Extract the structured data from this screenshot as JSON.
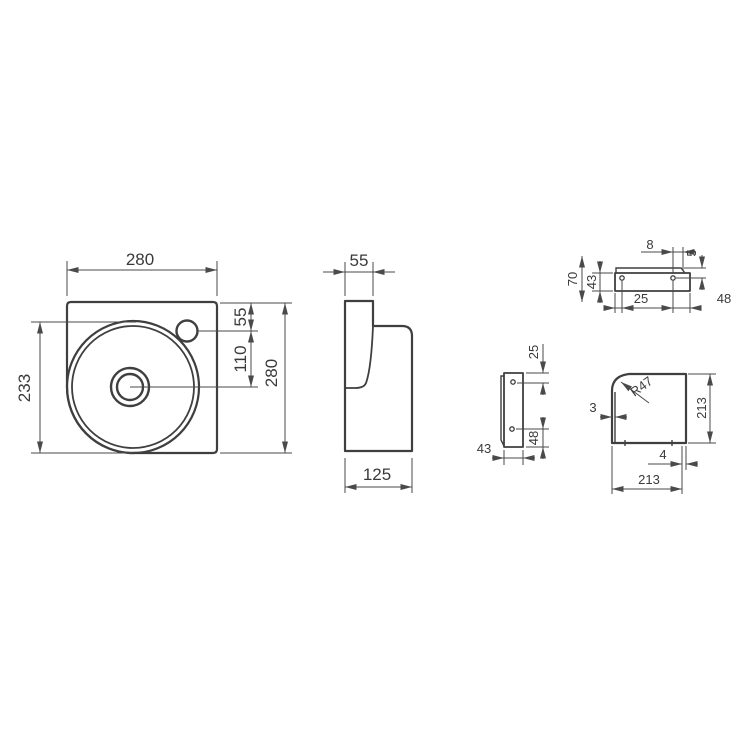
{
  "drawing_title": "washbasin-technical-drawing",
  "colors": {
    "background": "#ffffff",
    "outline": "#3f3f3f",
    "dimension_line": "#4a4a4a",
    "text": "#3a3a3a"
  },
  "front_view": {
    "width_mm": "280",
    "height_mm": "280",
    "bowl_to_bottom_mm": "233",
    "tap_hole_offset_mm": "55",
    "tap_to_drain_mm": "110"
  },
  "side_view": {
    "top_depth_mm": "55",
    "base_depth_mm": "125"
  },
  "bracket_front_view": {
    "hole_to_end_mm": "8",
    "lip_mm": "5",
    "overall_height_mm": "70",
    "body_height_mm": "43",
    "left_hole_mm": "25",
    "right_hole_mm": "48"
  },
  "bracket_side_view": {
    "top_hole_mm": "25",
    "bottom_hole_mm": "48",
    "depth_mm": "43"
  },
  "shelf_view": {
    "corner_radius": "R47",
    "left_lip_mm": "3",
    "height_mm": "213",
    "right_lip_mm": "4",
    "width_mm": "213"
  }
}
